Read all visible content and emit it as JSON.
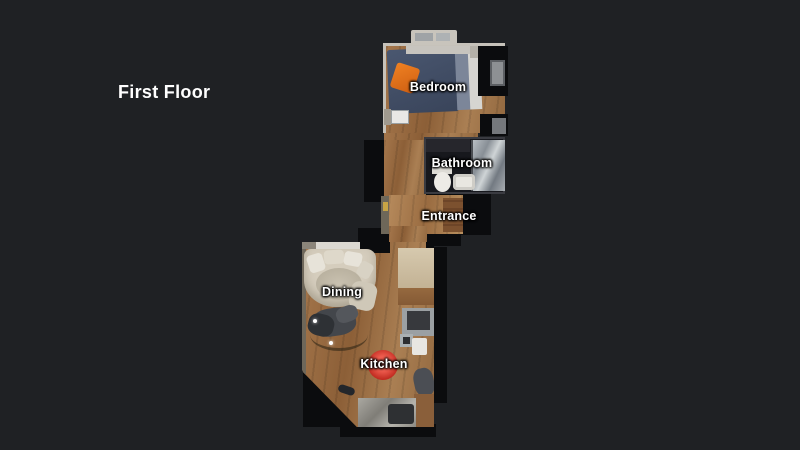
{
  "header": {
    "title": "First Floor"
  },
  "floorplan": {
    "floor_name": "First Floor",
    "rooms": [
      {
        "label": "Bedroom"
      },
      {
        "label": "Bathroom"
      },
      {
        "label": "Entrance"
      },
      {
        "label": "Dining"
      },
      {
        "label": "Kitchen"
      }
    ],
    "scan_points": 2
  },
  "colors": {
    "background": "#1f2124",
    "unscanned_cutout": "#0b0c0e",
    "label_text": "#ffffff",
    "wood_floor": "#9a6e46",
    "bed": "#3f4b63",
    "bed_pillow": "#e0701c",
    "sofa": "#d5cdbd",
    "kitchen_marker": "#c22d22",
    "scan_point": "#ffffff"
  }
}
